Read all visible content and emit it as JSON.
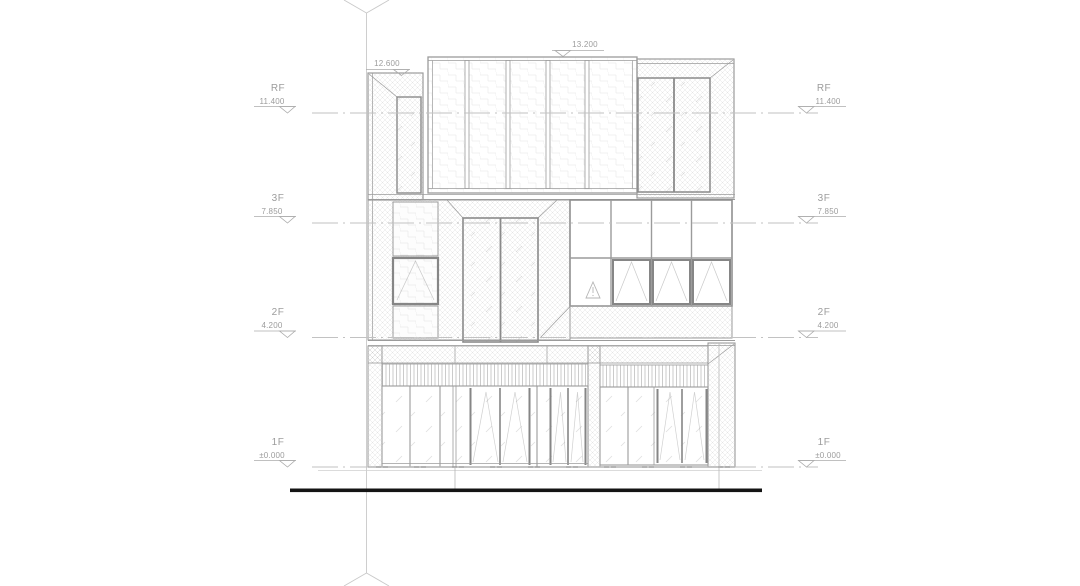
{
  "drawing": {
    "kind": "building-elevation",
    "levels": [
      {
        "name": "RF",
        "elevation": "11.400"
      },
      {
        "name": "3F",
        "elevation": "7.850"
      },
      {
        "name": "2F",
        "elevation": "4.200"
      },
      {
        "name": "1F",
        "elevation": "±0.000"
      }
    ],
    "top_dimensions": [
      {
        "value": "12.600"
      },
      {
        "value": "13.200"
      }
    ],
    "icons": {
      "warning_triangle": "△",
      "level_marker": "▽",
      "grid_axis_marker": "◇"
    },
    "colors": {
      "line": "#9b9b9b",
      "heavy_line": "#868686",
      "light_line": "#c6c6c6",
      "text": "#9c9c9c",
      "ground": "#141414"
    }
  }
}
